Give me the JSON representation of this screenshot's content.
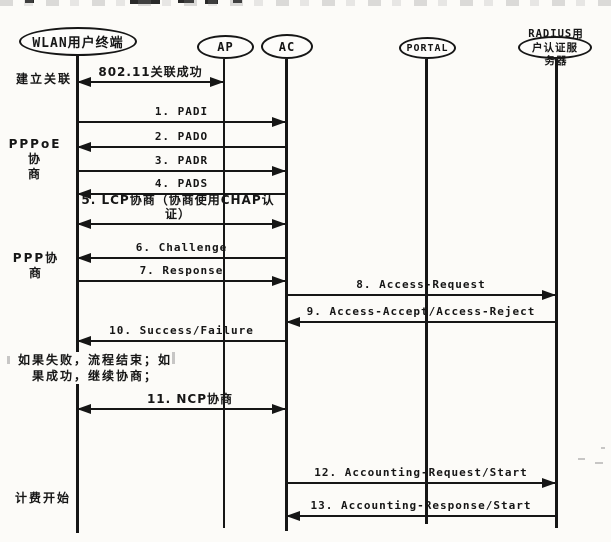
{
  "canvas": {
    "width": 611,
    "height": 542,
    "paper_color": "#fcfbf8",
    "ink_color": "#161616"
  },
  "diagram": {
    "actors": [
      {
        "id": "terminal",
        "label": "WLAN用户终端",
        "x": 77,
        "ellipse": {
          "left": 19,
          "top": 27,
          "width": 118,
          "height": 29
        },
        "font_size": 13,
        "line": {
          "top": 56,
          "bottom": 533,
          "width": 3
        }
      },
      {
        "id": "ap",
        "label": "AP",
        "x": 224,
        "ellipse": {
          "left": 197,
          "top": 35,
          "width": 57,
          "height": 24
        },
        "font_size": 12,
        "line": {
          "top": 59,
          "bottom": 528,
          "width": 2
        }
      },
      {
        "id": "ac",
        "label": "AC",
        "x": 286,
        "ellipse": {
          "left": 261,
          "top": 34,
          "width": 52,
          "height": 25
        },
        "font_size": 12,
        "line": {
          "top": 59,
          "bottom": 531,
          "width": 3
        }
      },
      {
        "id": "portal",
        "label": "PORTAL",
        "x": 426,
        "ellipse": {
          "left": 399,
          "top": 37,
          "width": 57,
          "height": 22
        },
        "font_size": 10,
        "line": {
          "top": 59,
          "bottom": 524,
          "width": 3
        }
      },
      {
        "id": "radius",
        "label": "户认证服",
        "label_above": "RADIUS用",
        "label_below": "务器",
        "x": 556,
        "ellipse": {
          "left": 518,
          "top": 36,
          "width": 74,
          "height": 23
        },
        "font_size": 10.5,
        "line": {
          "top": 59,
          "bottom": 528,
          "width": 3
        }
      }
    ],
    "messages": [
      {
        "label": "802.11关联成功",
        "from": "terminal",
        "to": "ap",
        "heads": "both",
        "y": 82
      },
      {
        "label": "1. PADI",
        "from": "terminal",
        "to": "ac",
        "y": 122
      },
      {
        "label": "2. PADO",
        "from": "ac",
        "to": "terminal",
        "y": 147
      },
      {
        "label": "3. PADR",
        "from": "terminal",
        "to": "ac",
        "y": 171
      },
      {
        "label": "4. PADS",
        "from": "ac",
        "to": "terminal",
        "y": 194
      },
      {
        "label": "5. LCP协商（协商使用CHAP认\n证）",
        "from": "terminal",
        "to": "ac",
        "heads": "both",
        "y": 224,
        "two_line": true,
        "label_cx": 178,
        "label_w": 212
      },
      {
        "label": "6. Challenge",
        "from": "ac",
        "to": "terminal",
        "y": 258
      },
      {
        "label": "7. Response",
        "from": "terminal",
        "to": "ac",
        "y": 281
      },
      {
        "label": "8. Access-Request",
        "from": "ac",
        "to": "radius",
        "y": 295
      },
      {
        "label": "9. Access-Accept/Access-Reject",
        "from": "radius",
        "to": "ac",
        "y": 322
      },
      {
        "label": "10. Success/Failure",
        "from": "ac",
        "to": "terminal",
        "y": 341
      },
      {
        "label": "11. NCP协商",
        "from": "terminal",
        "to": "ac",
        "heads": "both",
        "y": 409,
        "label_cx": 190
      },
      {
        "label": "12. Accounting-Request/Start",
        "from": "ac",
        "to": "radius",
        "y": 483
      },
      {
        "label": "13. Accounting-Response/Start",
        "from": "radius",
        "to": "ac",
        "y": 516
      }
    ],
    "phases": [
      {
        "id": "phase-establish-association",
        "label": "建立关联",
        "left": 11,
        "top": 72,
        "width": 66
      },
      {
        "id": "phase-pppoe-negotiation",
        "label": "PPPoE协\n商",
        "left": 4,
        "top": 137,
        "width": 62
      },
      {
        "id": "phase-ppp-negotiation",
        "label": "PPP协商",
        "left": 8,
        "top": 251,
        "width": 56
      },
      {
        "id": "note-failure-success",
        "label": "如果失败，流程结束；如\n果成功，继续协商；",
        "left": 10,
        "top": 352,
        "width": 170,
        "note": true
      },
      {
        "id": "phase-accounting-start",
        "label": "计费开始",
        "left": 8,
        "top": 491,
        "width": 70
      }
    ],
    "scan_artifacts": {
      "dark_marks": [
        [
          25,
          0,
          9,
          3
        ],
        [
          130,
          0,
          30,
          4
        ],
        [
          178,
          0,
          16,
          3
        ],
        [
          205,
          0,
          13,
          4
        ],
        [
          233,
          0,
          9,
          3
        ]
      ],
      "faint_marks": [
        [
          7,
          356,
          3,
          8
        ],
        [
          172,
          352,
          3,
          12
        ],
        [
          578,
          458,
          7,
          2
        ],
        [
          595,
          462,
          8,
          2
        ],
        [
          601,
          447,
          4,
          2
        ]
      ]
    }
  }
}
